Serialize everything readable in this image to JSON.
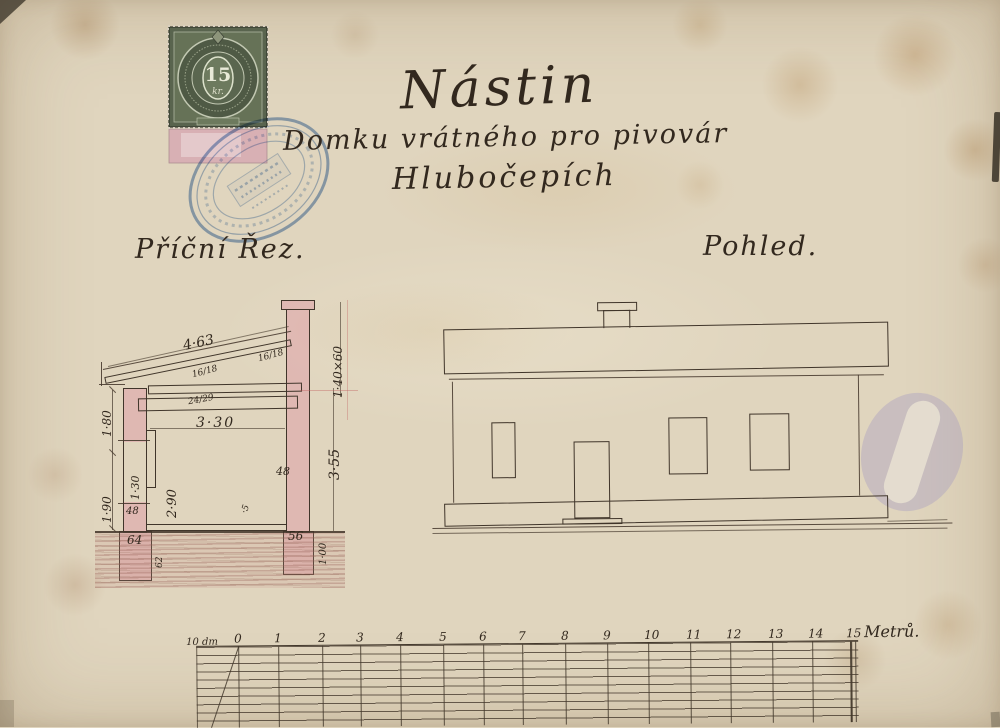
{
  "title_block": {
    "title": "Nástin",
    "line2": "Domku vrátného pro pivovár",
    "line3": "Hlubočepích"
  },
  "drawing_labels": {
    "cross_section": "Příční Řez.",
    "elevation": "Pohled."
  },
  "revenue_stamp": {
    "value": "15",
    "unit": "kr."
  },
  "cross_section": {
    "dimensions": {
      "roof_slope": "4·63",
      "rafter_upper": "16/18",
      "rafter_mid": "16/18",
      "beam_lower": "24/29",
      "chimney": "1·40×60",
      "height_right": "3·55",
      "interior_width": "3·30",
      "interior_height": "2·90",
      "wall_right": "48",
      "left_upper": "1·80",
      "left_lower": "1·90",
      "window_height": "1·30",
      "wall_left": "48",
      "floor_layer": "·5",
      "foundation_left_width": "64",
      "foundation_left_depth": "62",
      "foundation_right_width": "56",
      "foundation_right_depth": "1·00"
    }
  },
  "scale_bar": {
    "left_label": "10 dm",
    "ticks": [
      "0",
      "1",
      "2",
      "3",
      "4",
      "5",
      "6",
      "7",
      "8",
      "9",
      "10",
      "11",
      "12",
      "13",
      "14",
      "15"
    ],
    "unit_label": "Metrů."
  },
  "colors": {
    "paper": "#e0d5be",
    "ink": "#32281e",
    "wall_pink": "#dca6ad",
    "stamp_green": "#59644e",
    "stamp_blue": "#4273b8",
    "smudge_purple": "#948ac4"
  }
}
